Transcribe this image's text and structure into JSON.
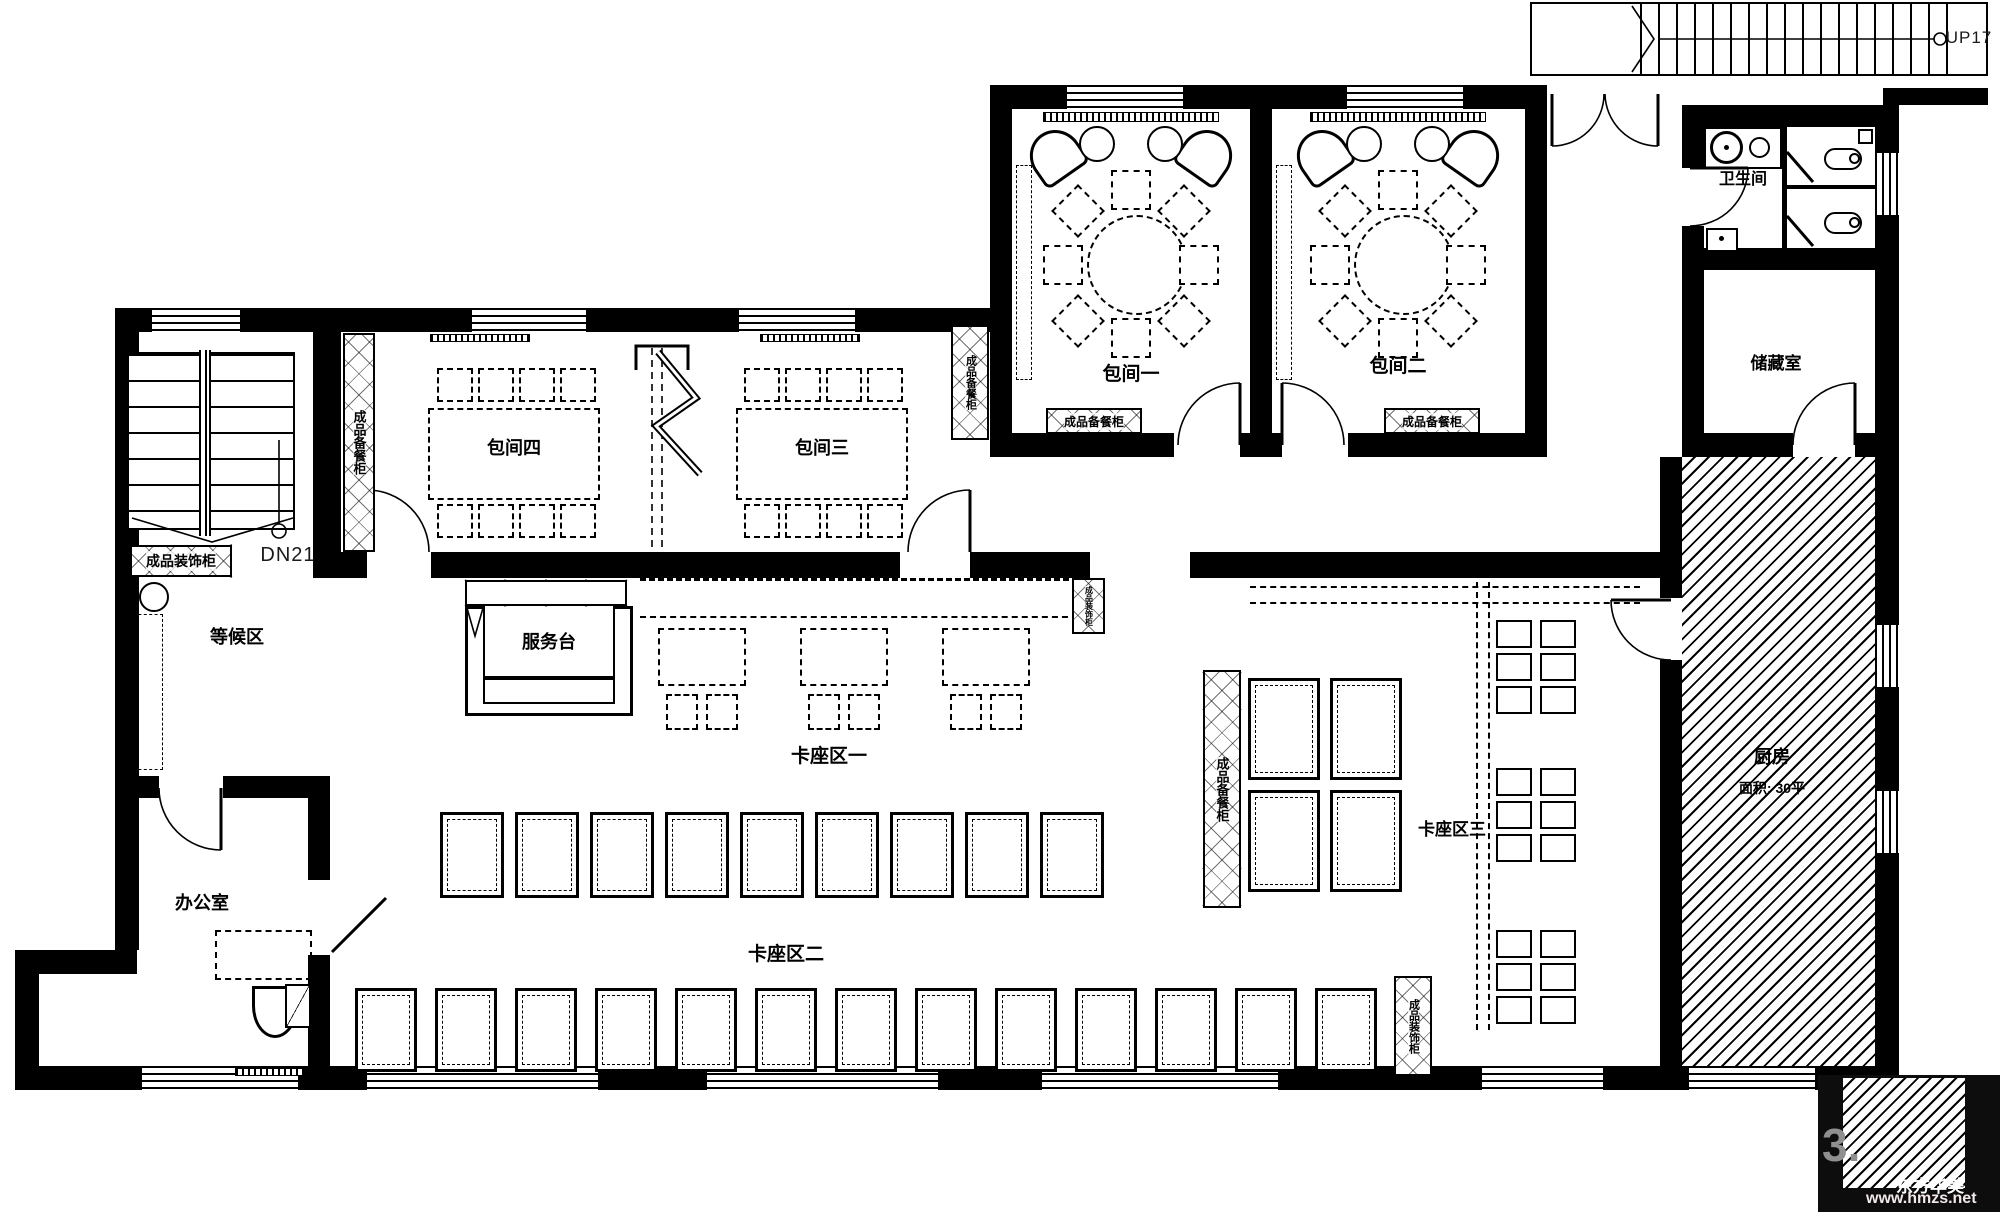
{
  "title": "restaurant-floor-plan",
  "labels": {
    "room1": "包间一",
    "room2": "包间二",
    "room3": "包间三",
    "room4": "包间四",
    "restroom": "卫生间",
    "storage": "储藏室",
    "kitchen": "厨房",
    "kitchen_area": "面积: 30平",
    "waiting": "等候区",
    "office": "办公室",
    "service_desk": "服务台",
    "booth1": "卡座区一",
    "booth2": "卡座区二",
    "booth3": "卡座区三",
    "cabinet_prep": "成品备餐柜",
    "cabinet_deco": "成品装饰柜",
    "stair_up": "UP17",
    "stair_down": "DN21"
  },
  "watermark": {
    "number": "3.",
    "brand": "东方华美",
    "url": "www.hmzs.net"
  },
  "colors": {
    "ink": "#000000",
    "paper": "#ffffff",
    "watermark_gray": "#8f8f8f"
  }
}
